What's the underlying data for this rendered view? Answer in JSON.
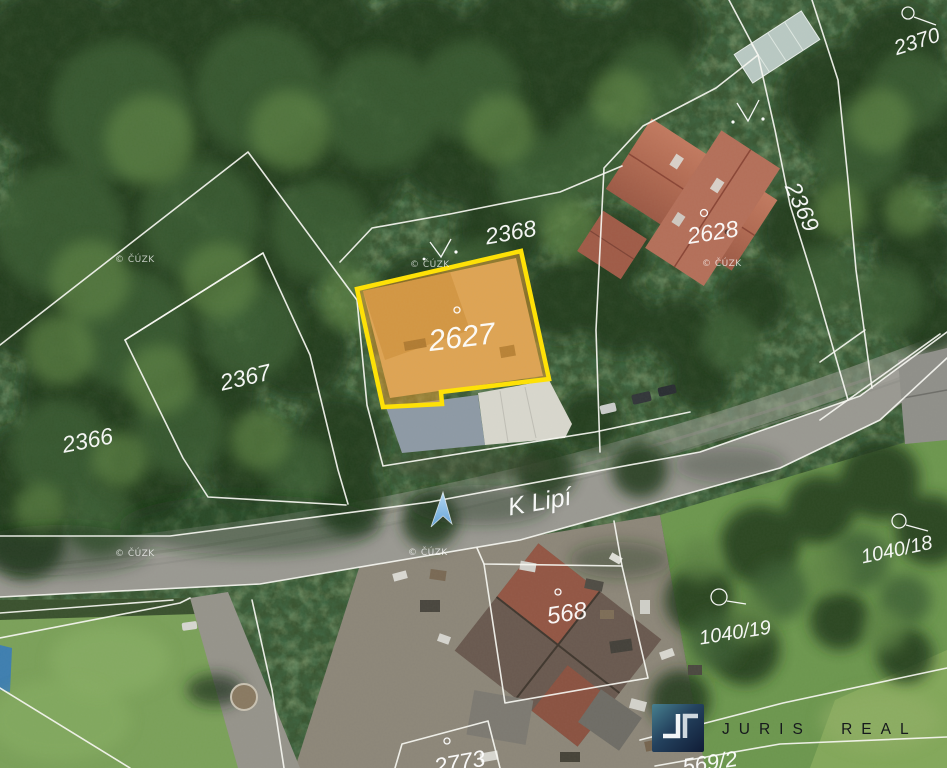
{
  "map": {
    "type": "cadastral-aerial-photo",
    "street": {
      "name": "K Lipí"
    },
    "copyright": "© ČÚZK",
    "highlight": {
      "parcel": "2627",
      "border_color": "#ffe205",
      "fill_color": "rgba(232,156,45,0.5)"
    },
    "parcels": {
      "p2370": "2370",
      "p2369": "2369",
      "p2628": "2628",
      "p2368": "2368",
      "p2627": "2627",
      "p2367": "2367",
      "p2366": "2366",
      "p1040_18": "1040/18",
      "p568": "568",
      "p1040_19": "1040/19",
      "p2773": "2773",
      "p569_2": "569/2"
    },
    "marker": {
      "type": "direction-arrow",
      "color": "#8fc2ee"
    },
    "line_color": "#ffffff",
    "label_color": "#ffffff"
  },
  "branding": {
    "name": "JURIS REAL"
  }
}
